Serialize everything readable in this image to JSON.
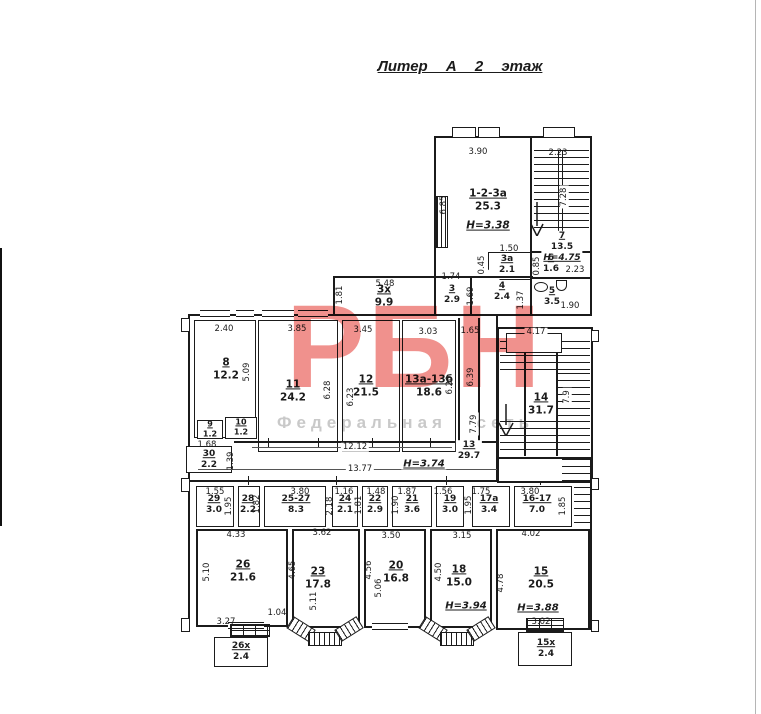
{
  "title": "Литер  А  2 этаж",
  "watermark": {
    "brand": "РБН",
    "subtitle": "Федеральная сеть",
    "brand_color": "#f0918d",
    "subtitle_color": "#c9c9c9"
  },
  "rooms": [
    {
      "label": "1-2-3а",
      "area": "25.3",
      "h": "Н=3.38"
    },
    {
      "label": "7",
      "area": "13.5",
      "h": "Н=4.75"
    },
    {
      "label": "6",
      "area": "1.6"
    },
    {
      "label": "3а",
      "area": "2.1"
    },
    {
      "label": "3",
      "area": "2.9"
    },
    {
      "label": "4",
      "area": "2.4"
    },
    {
      "label": "5",
      "area": "3.5"
    },
    {
      "label": "3х",
      "area": "9.9"
    },
    {
      "label": "8",
      "area": "12.2"
    },
    {
      "label": "11",
      "area": "24.2"
    },
    {
      "label": "12",
      "area": "21.5"
    },
    {
      "label": "13а-13б",
      "area": "18.6"
    },
    {
      "label": "14",
      "area": "31.7"
    },
    {
      "label": "9",
      "area": "1.2"
    },
    {
      "label": "10",
      "area": "1.2"
    },
    {
      "label": "30",
      "area": "2.2"
    },
    {
      "label": "13",
      "area": "29.7",
      "h": "Н=3.74"
    },
    {
      "label": "29",
      "area": "3.0"
    },
    {
      "label": "28",
      "area": "2.2"
    },
    {
      "label": "25-27",
      "area": "8.3"
    },
    {
      "label": "24",
      "area": "2.1"
    },
    {
      "label": "22",
      "area": "2.9"
    },
    {
      "label": "21",
      "area": "3.6"
    },
    {
      "label": "19",
      "area": "3.0"
    },
    {
      "label": "17а",
      "area": "3.4"
    },
    {
      "label": "16-17",
      "area": "7.0"
    },
    {
      "label": "26",
      "area": "21.6"
    },
    {
      "label": "23",
      "area": "17.8"
    },
    {
      "label": "20",
      "area": "16.8"
    },
    {
      "label": "18",
      "area": "15.0",
      "h": "Н=3.94"
    },
    {
      "label": "15",
      "area": "20.5",
      "h": "Н=3.88"
    },
    {
      "label": "26х",
      "area": "2.4"
    },
    {
      "label": "15х",
      "area": "2.4"
    }
  ],
  "dims": [
    "3.90",
    "6.85",
    "2.23",
    "7.28",
    "1.50",
    "0.45",
    "1.74",
    "1.69",
    "1.37",
    "0.85",
    "2.23",
    "1.90",
    "5.48",
    "1.81",
    "2.40",
    "3.85",
    "3.45",
    "3.03",
    "1.65",
    "4.17",
    "5.09",
    "6.28",
    "6.23",
    "6.20",
    "6.39",
    "7.9",
    "7.79",
    "1.68",
    "1.39",
    "12.12",
    "13.77",
    "1.55",
    "1.95",
    "1.82",
    "3.80",
    "2.18",
    "1.16",
    "1.81",
    "1.48",
    "1.87",
    "1.90",
    "1.56",
    "1.75",
    "1.95",
    "3.80",
    "1.85",
    "4.33",
    "5.10",
    "3.27",
    "1.04",
    "3.62",
    "4.65",
    "5.11",
    "3.50",
    "4.56",
    "5.06",
    "3.15",
    "4.50",
    "4.78",
    "4.02",
    "3.02"
  ]
}
